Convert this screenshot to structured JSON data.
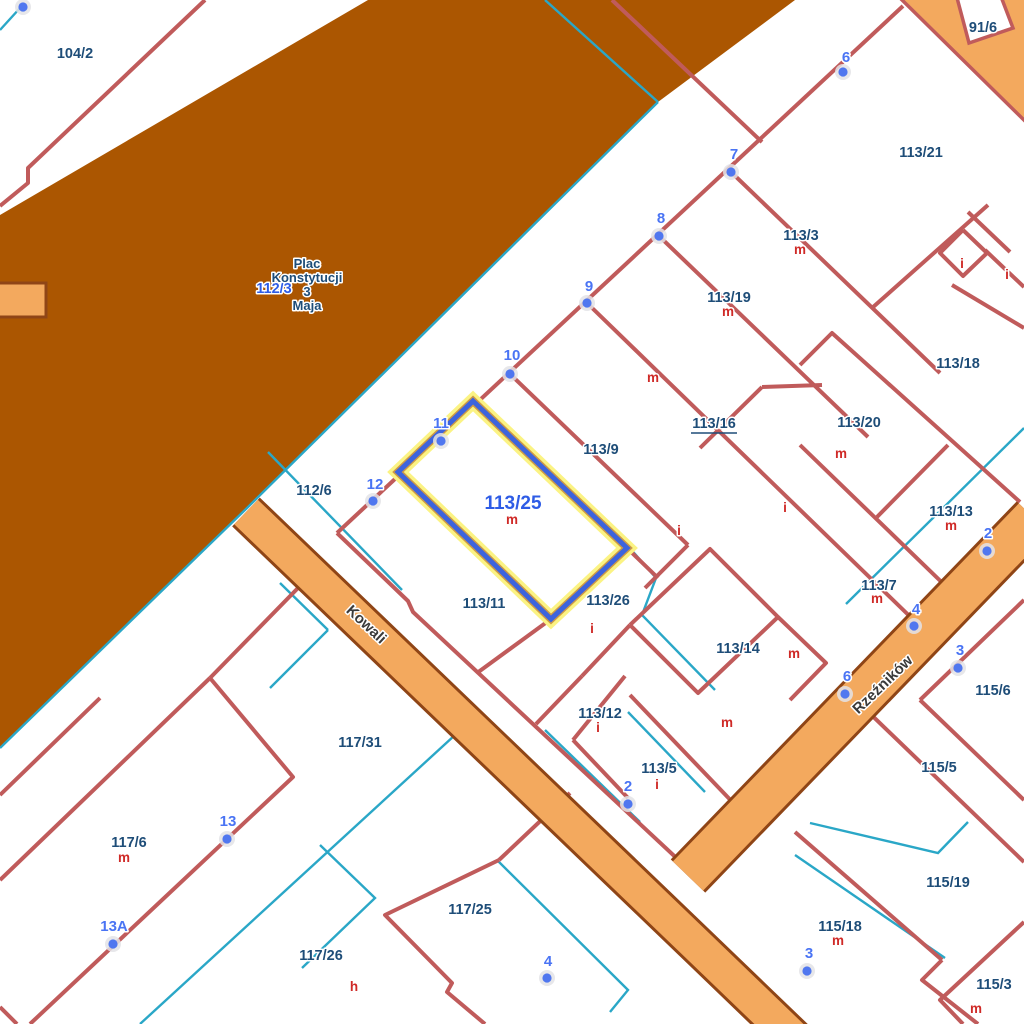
{
  "map": {
    "colors": {
      "background": "#ffffff",
      "plaza_fill": "#ab5601",
      "street_fill": "#f3a95e",
      "street_casing": "#8f4516",
      "corner_casing": "#c05b5b",
      "parcel_line": "#c05b5b",
      "utility_line": "#2aa7c7",
      "selection_halo": "#fbf383",
      "selection_mid": "#cf9a45",
      "selection_line": "#3d64dd",
      "label_navy": "#1e4d78",
      "label_blue": "#2e5ce6",
      "address_blue": "#4a74f4",
      "building_red": "#cf2a27",
      "street_label": "#3a3a3a",
      "dot_fill": "#5077ef",
      "dot_halo": "#e3e3e6"
    },
    "plaza": {
      "name_lines": [
        "Plac",
        "Konstytucji",
        "3",
        "Maja"
      ],
      "name_x": 307,
      "name_y": [
        268,
        282,
        296,
        310
      ],
      "parcel_label": "112/3",
      "parcel_x": 274,
      "parcel_y": 293,
      "polygon": [
        [
          368,
          0
        ],
        [
          795,
          0
        ],
        [
          658,
          102
        ],
        [
          247,
          508
        ],
        [
          0,
          748
        ],
        [
          0,
          215
        ]
      ]
    },
    "streets": [
      {
        "name": "Kowali",
        "label_x": 363,
        "label_y": 628,
        "rotation": 43,
        "path": [
          [
            246,
            512
          ],
          [
            700,
            948
          ],
          [
            808,
            1052
          ]
        ],
        "width": 34,
        "casing": 40
      },
      {
        "name": "Rzeźników",
        "label_x": 886,
        "label_y": 688,
        "rotation": -44,
        "path": [
          [
            1034,
            518
          ],
          [
            688,
            876
          ]
        ],
        "width": 42,
        "casing": 48
      }
    ],
    "street_stub": [
      [
        -8,
        283
      ],
      [
        46,
        283
      ],
      [
        46,
        317
      ],
      [
        -8,
        317
      ]
    ],
    "corner_street": {
      "polygon": [
        [
          898,
          -4
        ],
        [
          1030,
          -4
        ],
        [
          1030,
          126
        ]
      ],
      "notch": [
        [
          956,
          -6
        ],
        [
          1000,
          -6
        ],
        [
          1013,
          28
        ],
        [
          969,
          43
        ]
      ]
    },
    "selected_parcel": {
      "label": "113/25",
      "label_x": 513,
      "label_y": 509,
      "building_label": "m",
      "building_x": 512,
      "building_y": 524,
      "polygon": [
        [
          473,
          401
        ],
        [
          627,
          548
        ],
        [
          551,
          619
        ],
        [
          398,
          472
        ]
      ]
    },
    "parcel_labels": [
      {
        "text": "104/2",
        "x": 75,
        "y": 58
      },
      {
        "text": "91/6",
        "x": 983,
        "y": 32
      },
      {
        "text": "113/21",
        "x": 921,
        "y": 157
      },
      {
        "text": "113/3",
        "x": 801,
        "y": 240
      },
      {
        "text": "113/19",
        "x": 729,
        "y": 302
      },
      {
        "text": "113/18",
        "x": 958,
        "y": 368
      },
      {
        "text": "113/16",
        "x": 714,
        "y": 428,
        "underline": true
      },
      {
        "text": "113/20",
        "x": 859,
        "y": 427
      },
      {
        "text": "113/9",
        "x": 601,
        "y": 454
      },
      {
        "text": "112/6",
        "x": 314,
        "y": 495
      },
      {
        "text": "113/13",
        "x": 951,
        "y": 516
      },
      {
        "text": "113/7",
        "x": 879,
        "y": 590
      },
      {
        "text": "113/11",
        "x": 484,
        "y": 608
      },
      {
        "text": "113/26",
        "x": 608,
        "y": 605
      },
      {
        "text": "113/14",
        "x": 738,
        "y": 653
      },
      {
        "text": "115/6",
        "x": 993,
        "y": 695
      },
      {
        "text": "113/12",
        "x": 600,
        "y": 718
      },
      {
        "text": "113/5",
        "x": 659,
        "y": 773
      },
      {
        "text": "115/5",
        "x": 939,
        "y": 772
      },
      {
        "text": "117/31",
        "x": 360,
        "y": 747
      },
      {
        "text": "117/6",
        "x": 129,
        "y": 847
      },
      {
        "text": "117/25",
        "x": 470,
        "y": 914
      },
      {
        "text": "117/26",
        "x": 321,
        "y": 960
      },
      {
        "text": "115/19",
        "x": 948,
        "y": 887
      },
      {
        "text": "115/18",
        "x": 840,
        "y": 931
      },
      {
        "text": "115/3",
        "x": 994,
        "y": 989
      },
      {
        "text": "112/3",
        "x": 274,
        "y": 293,
        "blue": true
      }
    ],
    "building_labels": [
      {
        "text": "m",
        "x": 800,
        "y": 254
      },
      {
        "text": "m",
        "x": 728,
        "y": 316
      },
      {
        "text": "m",
        "x": 841,
        "y": 458
      },
      {
        "text": "m",
        "x": 951,
        "y": 530
      },
      {
        "text": "m",
        "x": 877,
        "y": 603
      },
      {
        "text": "i",
        "x": 598,
        "y": 732
      },
      {
        "text": "i",
        "x": 657,
        "y": 789
      },
      {
        "text": "m",
        "x": 124,
        "y": 862
      },
      {
        "text": "m",
        "x": 838,
        "y": 945
      },
      {
        "text": "m",
        "x": 976,
        "y": 1013
      },
      {
        "text": "m",
        "x": 653,
        "y": 382
      },
      {
        "text": "i",
        "x": 962,
        "y": 268
      },
      {
        "text": "i",
        "x": 1007,
        "y": 279
      },
      {
        "text": "i",
        "x": 679,
        "y": 535
      },
      {
        "text": "i",
        "x": 785,
        "y": 512
      },
      {
        "text": "i",
        "x": 592,
        "y": 633
      },
      {
        "text": "m",
        "x": 794,
        "y": 658
      },
      {
        "text": "m",
        "x": 727,
        "y": 727
      },
      {
        "text": "h",
        "x": 354,
        "y": 991
      }
    ],
    "address_points": [
      {
        "label": "",
        "dot": [
          23,
          7
        ]
      },
      {
        "label": "6",
        "dot": [
          843,
          72
        ],
        "lx": 846,
        "ly": 62
      },
      {
        "label": "7",
        "dot": [
          731,
          172
        ],
        "lx": 734,
        "ly": 159
      },
      {
        "label": "8",
        "dot": [
          659,
          236
        ],
        "lx": 661,
        "ly": 223
      },
      {
        "label": "9",
        "dot": [
          587,
          303
        ],
        "lx": 589,
        "ly": 291
      },
      {
        "label": "10",
        "dot": [
          510,
          374
        ],
        "lx": 512,
        "ly": 360
      },
      {
        "label": "11",
        "dot": [
          441,
          441
        ],
        "lx": 441,
        "ly": 428
      },
      {
        "label": "12",
        "dot": [
          373,
          501
        ],
        "lx": 375,
        "ly": 489
      },
      {
        "label": "2",
        "dot": [
          628,
          804
        ],
        "lx": 628,
        "ly": 791
      },
      {
        "label": "4",
        "dot": [
          547,
          978
        ],
        "lx": 548,
        "ly": 966
      },
      {
        "label": "13",
        "dot": [
          227,
          839
        ],
        "lx": 228,
        "ly": 826
      },
      {
        "label": "13A",
        "dot": [
          113,
          944
        ],
        "lx": 114,
        "ly": 931
      },
      {
        "label": "2",
        "dot": [
          987,
          551
        ],
        "lx": 988,
        "ly": 538
      },
      {
        "label": "4",
        "dot": [
          914,
          626
        ],
        "lx": 916,
        "ly": 614
      },
      {
        "label": "3",
        "dot": [
          958,
          668
        ],
        "lx": 960,
        "ly": 655
      },
      {
        "label": "6",
        "dot": [
          845,
          694
        ],
        "lx": 847,
        "ly": 681
      },
      {
        "label": "3",
        "dot": [
          807,
          971
        ],
        "lx": 809,
        "ly": 958
      }
    ],
    "parcel_lines": [
      [
        [
          205,
          0
        ],
        [
          28,
          168
        ],
        [
          28,
          183
        ],
        [
          0,
          206
        ]
      ],
      [
        [
          903,
          6
        ],
        [
          337,
          533
        ]
      ],
      [
        [
          612,
          0
        ],
        [
          762,
          142
        ]
      ],
      [
        [
          731,
          172
        ],
        [
          940,
          373
        ]
      ],
      [
        [
          659,
          236
        ],
        [
          868,
          437
        ]
      ],
      [
        [
          587,
          303
        ],
        [
          928,
          634
        ]
      ],
      [
        [
          510,
          374
        ],
        [
          688,
          545
        ]
      ],
      [
        [
          473,
          401
        ],
        [
          627,
          548
        ],
        [
          551,
          619
        ],
        [
          398,
          472
        ],
        [
          473,
          401
        ]
      ],
      [
        [
          337,
          533
        ],
        [
          408,
          601
        ],
        [
          413,
          612
        ],
        [
          700,
          880
        ]
      ],
      [
        [
          800,
          365
        ],
        [
          832,
          333
        ],
        [
          1020,
          502
        ]
      ],
      [
        [
          762,
          387
        ],
        [
          822,
          385
        ]
      ],
      [
        [
          762,
          387
        ],
        [
          700,
          448
        ]
      ],
      [
        [
          800,
          445
        ],
        [
          958,
          598
        ]
      ],
      [
        [
          948,
          445
        ],
        [
          877,
          517
        ]
      ],
      [
        [
          988,
          205
        ],
        [
          872,
          308
        ]
      ],
      [
        [
          968,
          212
        ],
        [
          1010,
          252
        ]
      ],
      [
        [
          963,
          230
        ],
        [
          987,
          253
        ],
        [
          963,
          276
        ],
        [
          940,
          253
        ],
        [
          963,
          230
        ]
      ],
      [
        [
          985,
          250
        ],
        [
          1024,
          287
        ]
      ],
      [
        [
          952,
          285
        ],
        [
          1024,
          328
        ]
      ],
      [
        [
          1024,
          518
        ],
        [
          745,
          792
        ]
      ],
      [
        [
          1024,
          600
        ],
        [
          920,
          700
        ]
      ],
      [
        [
          920,
          700
        ],
        [
          1024,
          800
        ]
      ],
      [
        [
          858,
          702
        ],
        [
          1024,
          862
        ]
      ],
      [
        [
          795,
          832
        ],
        [
          942,
          960
        ]
      ],
      [
        [
          942,
          960
        ],
        [
          922,
          980
        ],
        [
          978,
          1024
        ]
      ],
      [
        [
          1024,
          922
        ],
        [
          940,
          1000
        ],
        [
          963,
          1024
        ]
      ],
      [
        [
          700,
          960
        ],
        [
          766,
          1024
        ]
      ],
      [
        [
          210,
          678
        ],
        [
          293,
          777
        ],
        [
          30,
          1024
        ]
      ],
      [
        [
          210,
          678
        ],
        [
          0,
          880
        ]
      ],
      [
        [
          210,
          678
        ],
        [
          298,
          588
        ]
      ],
      [
        [
          499,
          860
        ],
        [
          570,
          793
        ]
      ],
      [
        [
          499,
          860
        ],
        [
          385,
          915
        ],
        [
          452,
          983
        ],
        [
          447,
          992
        ],
        [
          485,
          1024
        ]
      ],
      [
        [
          0,
          1007
        ],
        [
          17,
          1024
        ]
      ],
      [
        [
          551,
          619
        ],
        [
          477,
          673
        ]
      ],
      [
        [
          582,
          676
        ],
        [
          536,
          724
        ]
      ],
      [
        [
          625,
          676
        ],
        [
          573,
          740
        ]
      ],
      [
        [
          573,
          740
        ],
        [
          628,
          798
        ]
      ],
      [
        [
          630,
          695
        ],
        [
          740,
          810
        ]
      ],
      [
        [
          740,
          810
        ],
        [
          700,
          852
        ]
      ],
      [
        [
          630,
          625
        ],
        [
          582,
          676
        ]
      ],
      [
        [
          630,
          625
        ],
        [
          710,
          549
        ],
        [
          778,
          617
        ],
        [
          698,
          693
        ],
        [
          630,
          625
        ]
      ],
      [
        [
          778,
          617
        ],
        [
          826,
          663
        ],
        [
          790,
          700
        ]
      ],
      [
        [
          627,
          548
        ],
        [
          658,
          578
        ]
      ],
      [
        [
          688,
          545
        ],
        [
          645,
          588
        ]
      ],
      [
        [
          0,
          795
        ],
        [
          100,
          698
        ]
      ]
    ],
    "utility_lines": [
      [
        [
          545,
          0
        ],
        [
          658,
          102
        ]
      ],
      [
        [
          658,
          102
        ],
        [
          247,
          508
        ],
        [
          0,
          748
        ]
      ],
      [
        [
          0,
          30
        ],
        [
          20,
          8
        ]
      ],
      [
        [
          268,
          452
        ],
        [
          402,
          590
        ]
      ],
      [
        [
          280,
          583
        ],
        [
          328,
          630
        ]
      ],
      [
        [
          328,
          630
        ],
        [
          270,
          688
        ]
      ],
      [
        [
          1024,
          428
        ],
        [
          846,
          604
        ]
      ],
      [
        [
          1024,
          558
        ],
        [
          872,
          708
        ]
      ],
      [
        [
          810,
          823
        ],
        [
          938,
          853
        ],
        [
          968,
          822
        ]
      ],
      [
        [
          795,
          855
        ],
        [
          945,
          958
        ]
      ],
      [
        [
          455,
          735
        ],
        [
          140,
          1024
        ]
      ],
      [
        [
          320,
          845
        ],
        [
          375,
          898
        ],
        [
          302,
          968
        ]
      ],
      [
        [
          497,
          860
        ],
        [
          628,
          990
        ],
        [
          610,
          1012
        ]
      ],
      [
        [
          598,
          862
        ],
        [
          688,
          948
        ]
      ],
      [
        [
          628,
          546
        ],
        [
          656,
          578
        ],
        [
          642,
          615
        ],
        [
          715,
          690
        ]
      ],
      [
        [
          545,
          730
        ],
        [
          640,
          822
        ]
      ],
      [
        [
          628,
          712
        ],
        [
          705,
          792
        ]
      ],
      [
        [
          912,
          4
        ],
        [
          930,
          0
        ]
      ]
    ]
  }
}
